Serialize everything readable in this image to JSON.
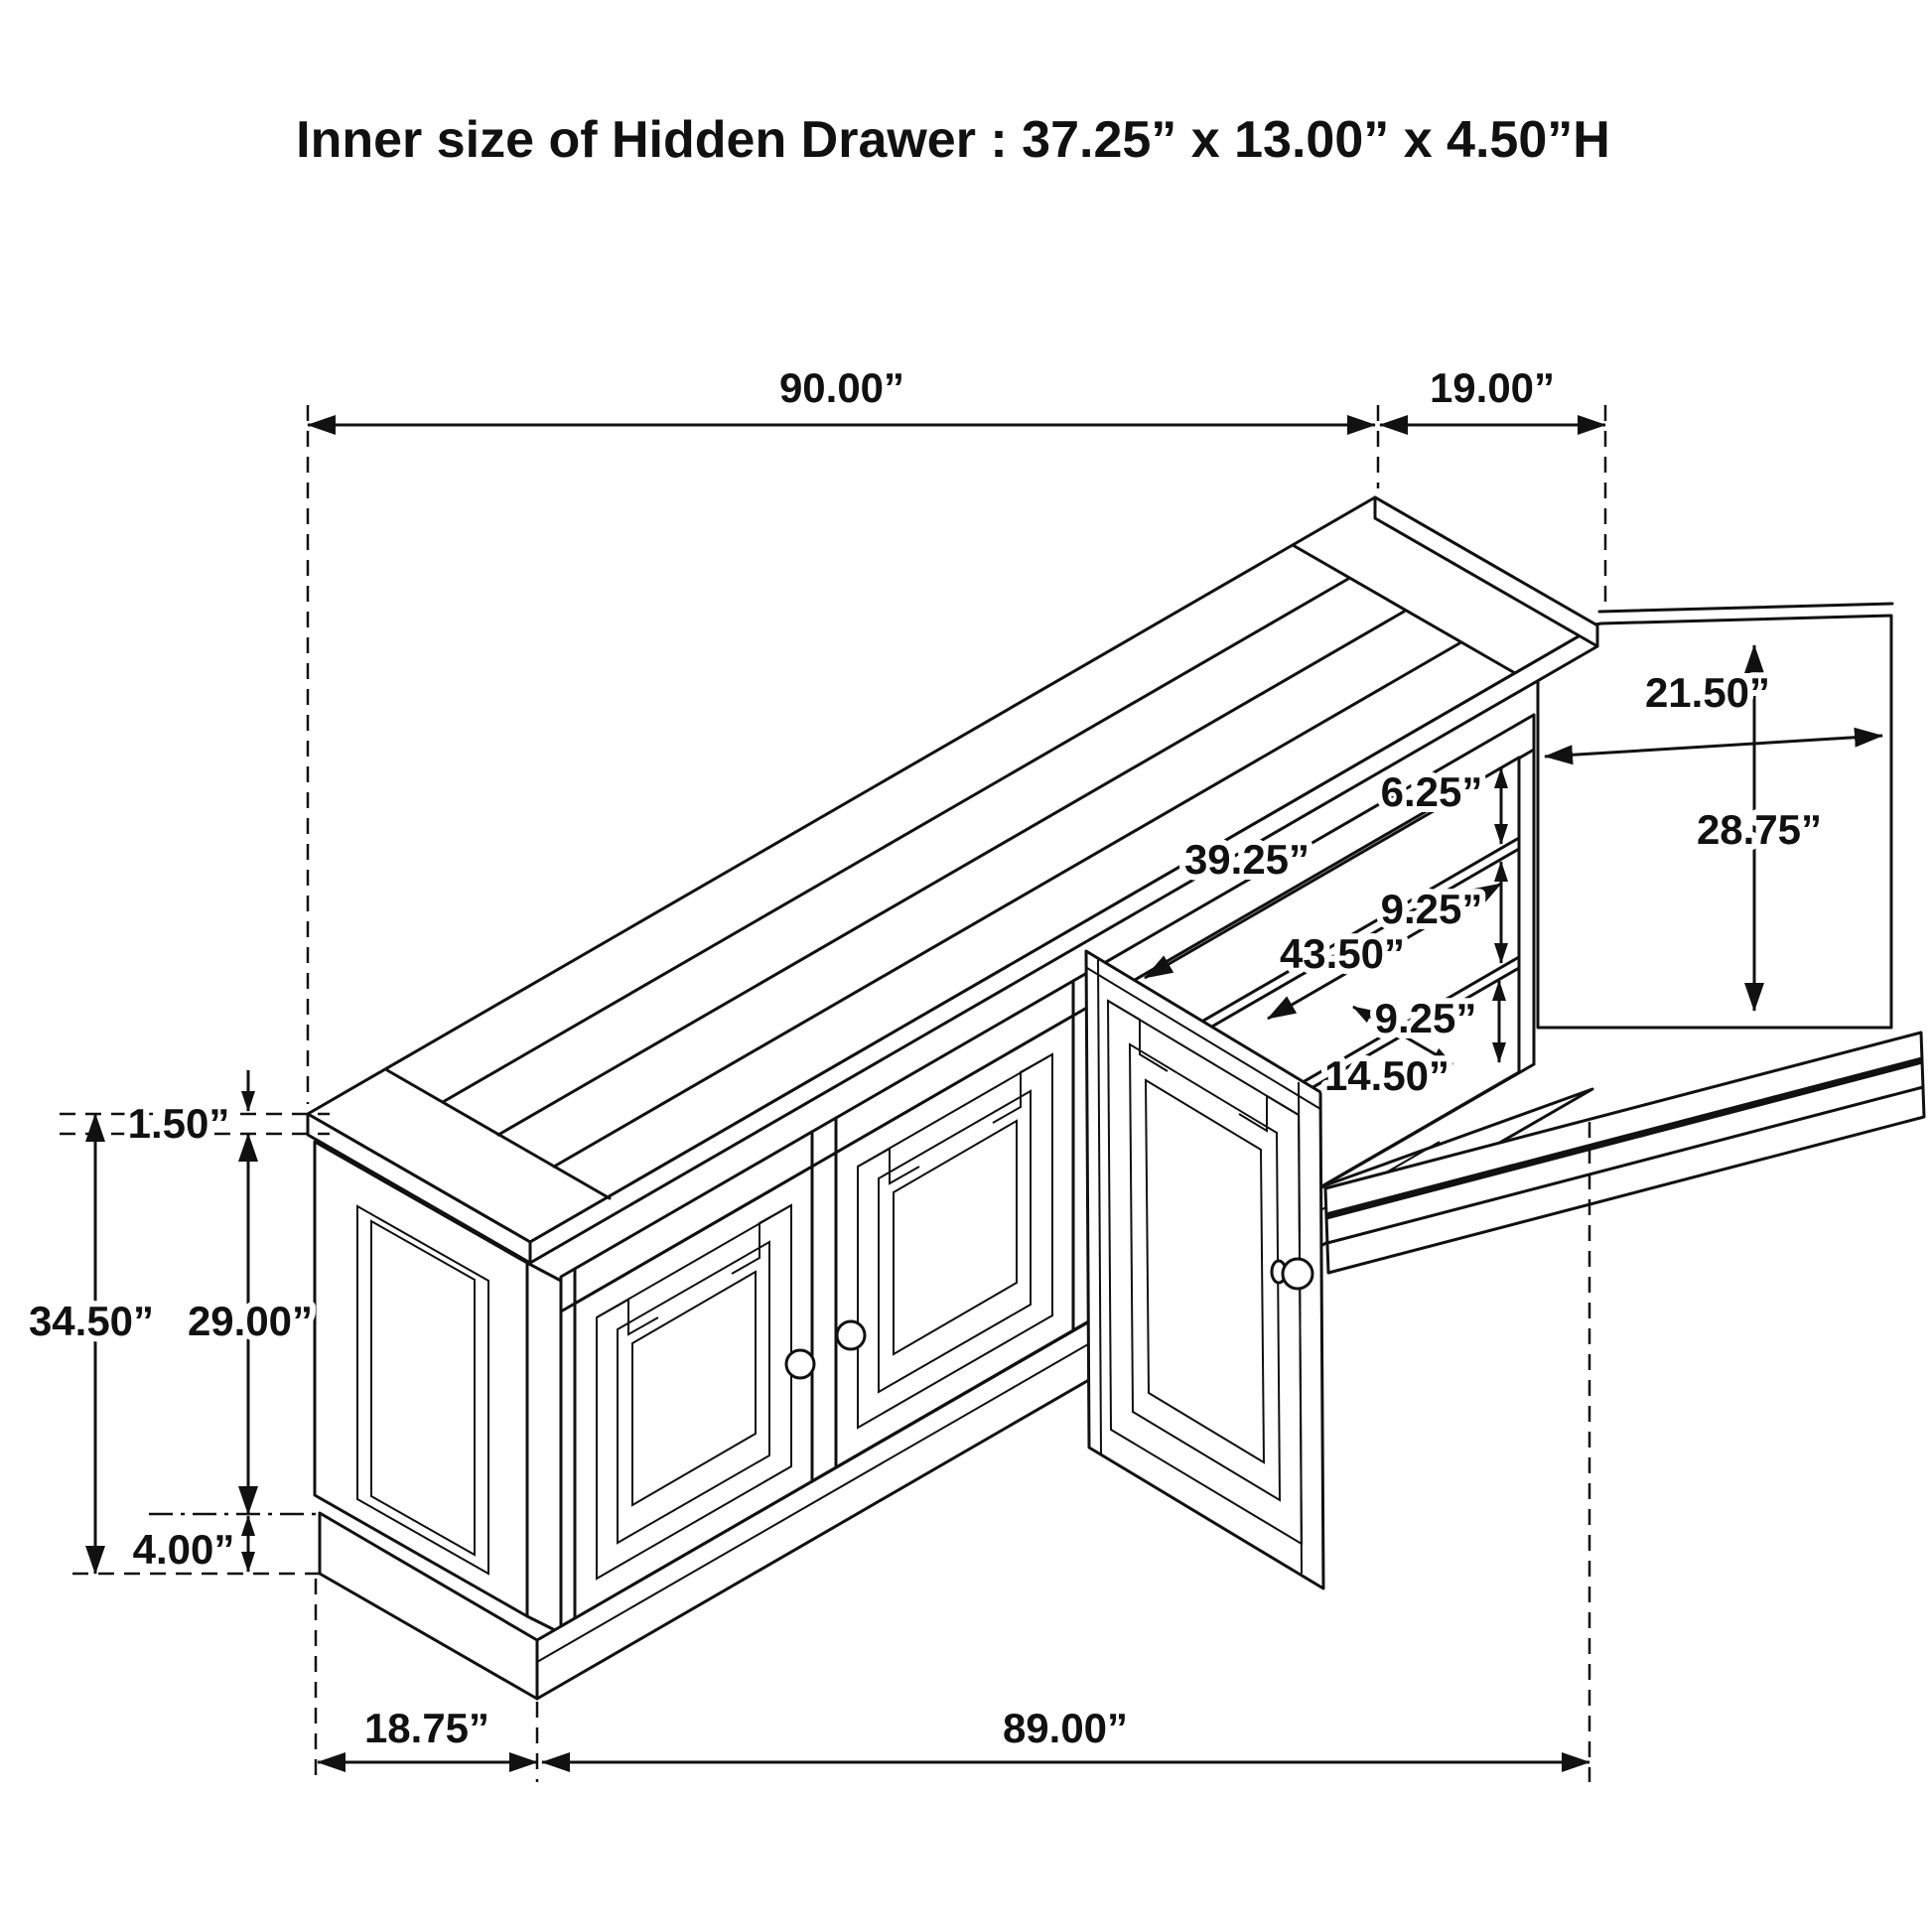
{
  "title": "Inner size of Hidden Drawer : 37.25” x 13.00” x 4.50”H",
  "dims": {
    "top_width": "90.00”",
    "top_depth": "19.00”",
    "body_width": "89.00”",
    "side_depth": "18.75”",
    "overall_height": "34.50”",
    "door_opening_height": "29.00”",
    "top_thickness": "1.50”",
    "base_height": "4.00”",
    "open_door_width": "21.50”",
    "open_door_height": "28.75”",
    "shelf_gap_top": "6.25”",
    "shelf_gap_upper": "9.25”",
    "shelf_gap_lower": "9.25”",
    "opening_width": "39.25”",
    "interior_width": "43.50”",
    "shelf_depth": "14.50”"
  },
  "colors": {
    "line": "#111111",
    "background": "#ffffff"
  }
}
